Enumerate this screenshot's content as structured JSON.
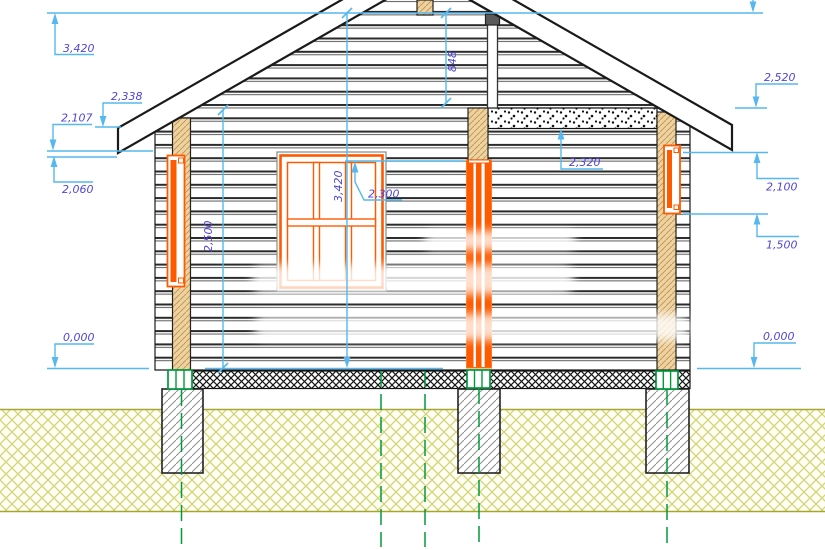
{
  "meta": {
    "drawing_type": "log-house facade elevation (CAD)",
    "units": "mm (levels with decimal comma)"
  },
  "colors": {
    "dimension_line": "#56b8ee",
    "dimension_text": "#4f46d8",
    "joinery_orange": "#ff5a00",
    "timber_fill": "#eed3a2",
    "axis_green": "#009a3c",
    "ground_hatch": "#d2d276",
    "outline": "#1a1a1a"
  },
  "labels": {
    "left": [
      {
        "id": "ridge-level",
        "value": "3,420"
      },
      {
        "id": "eave-edge-level",
        "value": "2,338"
      },
      {
        "id": "roof-underside",
        "value": "2,107"
      },
      {
        "id": "jack-top-level",
        "value": "2,060"
      },
      {
        "id": "floor-level",
        "value": "0,000"
      }
    ],
    "right": [
      {
        "id": "eaves-level",
        "value": "2,520"
      },
      {
        "id": "opening-top-level",
        "value": "2,100"
      },
      {
        "id": "sill-level",
        "value": "1,500"
      },
      {
        "id": "floor-level",
        "value": "0,000"
      }
    ],
    "middle": [
      {
        "id": "ceiling-band-level",
        "value": "2,320"
      },
      {
        "id": "gable-height",
        "value": "848"
      },
      {
        "id": "total-height",
        "value": "3,420"
      },
      {
        "id": "wall-height",
        "value": "2,500"
      },
      {
        "id": "door-top-level",
        "value": "2,300"
      }
    ]
  }
}
